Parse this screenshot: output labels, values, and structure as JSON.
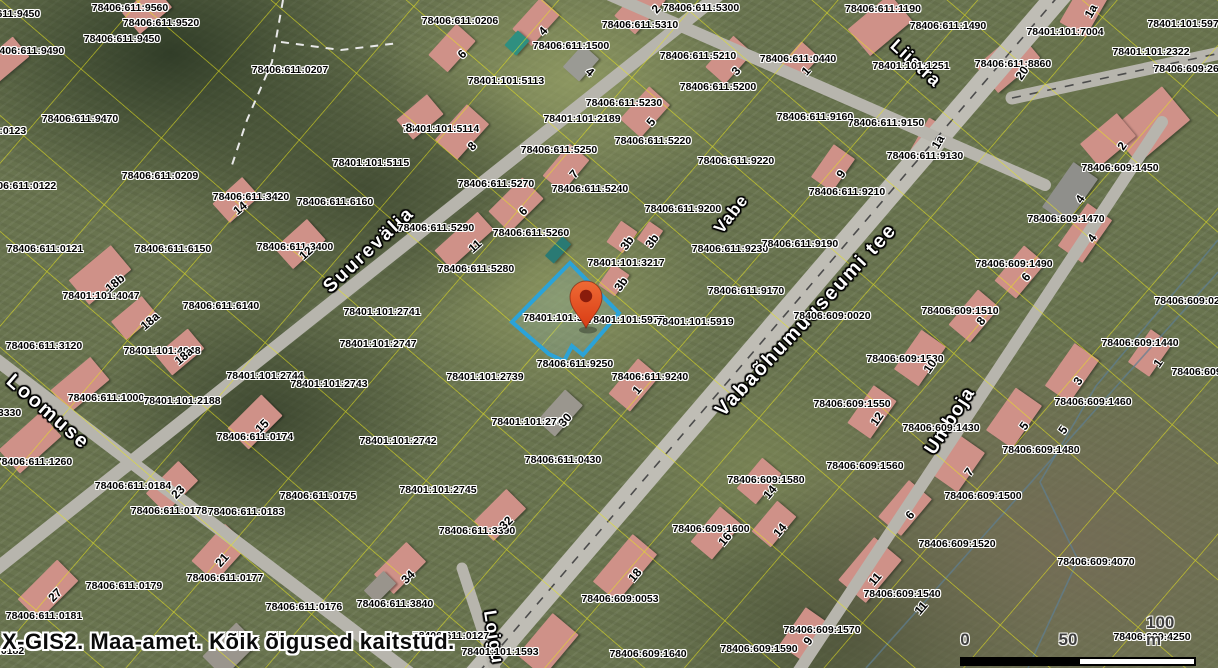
{
  "app": {
    "watermark": "X-GIS2. Maa-amet. Kõik õigused kaitstud."
  },
  "scalebar": {
    "label_0": "0",
    "label_50": "50",
    "label_100": "100 m"
  },
  "colors": {
    "parcel_line": "#e6e41c",
    "road": "#b7b5ad",
    "road_main": "#bfbdb5",
    "highlight": "#2ba3d8",
    "highlight_fill": "rgba(140,205,238,0.14)",
    "pin_top": "#ef6a35",
    "pin_bottom": "#d93c14",
    "pin_hole": "#8a1c0c",
    "dash": "#4c4c4c",
    "dash_white": "#e9e9e9",
    "stream": "#5e7f93",
    "building": "#cf9188",
    "scalebar_black": "#000000",
    "scalebar_white": "#ffffff"
  },
  "streets": [
    {
      "name": "Suurevälja",
      "x": 369,
      "y": 250,
      "rot": -43,
      "size": 19,
      "ls": 2
    },
    {
      "name": "Vabe",
      "x": 731,
      "y": 214,
      "rot": -52,
      "size": 17,
      "ls": 1
    },
    {
      "name": "Vabaõhumuuseumi tee",
      "x": 806,
      "y": 320,
      "rot": -47,
      "size": 20,
      "ls": 2
    },
    {
      "name": "Loomuse",
      "x": 48,
      "y": 412,
      "rot": 41,
      "size": 20,
      "ls": 2
    },
    {
      "name": "Umboja",
      "x": 950,
      "y": 421,
      "rot": -57,
      "size": 19,
      "ls": 1
    },
    {
      "name": "Liistra",
      "x": 916,
      "y": 63,
      "rot": 42,
      "size": 18,
      "ls": 1
    },
    {
      "name": "Loigu",
      "x": 494,
      "y": 637,
      "rot": 81,
      "size": 18,
      "ls": 1
    }
  ],
  "parcel_labels": [
    [
      "78406:611:9560",
      130,
      8
    ],
    [
      "78406:611:9520",
      161,
      23
    ],
    [
      "78406:611:9450",
      122,
      39
    ],
    [
      "78406:611:9450",
      2,
      14
    ],
    [
      "78406:611:9490",
      26,
      51
    ],
    [
      "78406:611:0207",
      290,
      70
    ],
    [
      "78406:611:9470",
      80,
      119
    ],
    [
      "78406:611:0123",
      -12,
      131
    ],
    [
      "78401:101:5115",
      371,
      163
    ],
    [
      "78401:101:5114",
      441,
      129
    ],
    [
      "78406:611:0206",
      460,
      21
    ],
    [
      "78406:611:5300",
      701,
      8
    ],
    [
      "78406:611:5310",
      640,
      25
    ],
    [
      "78406:611:1500",
      571,
      46
    ],
    [
      "78401:101:5113",
      506,
      81
    ],
    [
      "78406:611:5210",
      698,
      56
    ],
    [
      "78406:611:5200",
      718,
      87
    ],
    [
      "78406:611:0440",
      798,
      59
    ],
    [
      "78406:611:5230",
      624,
      103
    ],
    [
      "78401:101:2189",
      582,
      119
    ],
    [
      "78406:611:5220",
      653,
      141
    ],
    [
      "78406:611:5250",
      559,
      150
    ],
    [
      "78406:611:9220",
      736,
      161
    ],
    [
      "78406:611:1190",
      883,
      9
    ],
    [
      "78406:611:1490",
      948,
      26
    ],
    [
      "78401:101:7004",
      1065,
      32
    ],
    [
      "78401:101:5970",
      1186,
      24
    ],
    [
      "78401:101:2322",
      1151,
      52
    ],
    [
      "78406:609:2610",
      1192,
      69
    ],
    [
      "78401:101:1251",
      911,
      66
    ],
    [
      "78406:611:8860",
      1013,
      64
    ],
    [
      "78406:611:9160",
      815,
      117
    ],
    [
      "78406:611:9150",
      886,
      123
    ],
    [
      "78406:611:9130",
      925,
      156
    ],
    [
      "78406:609:1450",
      1120,
      168
    ],
    [
      "78406:611:0209",
      160,
      176
    ],
    [
      "78406:611:0122",
      18,
      186
    ],
    [
      "78406:611:3420",
      251,
      197
    ],
    [
      "78406:611:6160",
      335,
      202
    ],
    [
      "78406:611:0121",
      45,
      249
    ],
    [
      "78406:611:6150",
      173,
      249
    ],
    [
      "78406:611:3400",
      295,
      247
    ],
    [
      "78401:101:4047",
      101,
      296
    ],
    [
      "78406:611:6140",
      221,
      306
    ],
    [
      "78406:611:5270",
      496,
      184
    ],
    [
      "78406:611:5240",
      590,
      189
    ],
    [
      "78406:611:9200",
      683,
      209
    ],
    [
      "78406:611:5290",
      436,
      228
    ],
    [
      "78406:611:5260",
      531,
      233
    ],
    [
      "78406:611:5280",
      476,
      269
    ],
    [
      "78401:101:3217",
      626,
      263
    ],
    [
      "78406:611:9230",
      730,
      249
    ],
    [
      "78406:611:9170",
      746,
      291
    ],
    [
      "78406:611:9190",
      800,
      244
    ],
    [
      "78401:101:2741",
      382,
      312
    ],
    [
      "78401:101:32",
      556,
      318
    ],
    [
      "78401:101:5977",
      626,
      320
    ],
    [
      "78401:101:5919",
      695,
      322
    ],
    [
      "78406:611:9210",
      847,
      192
    ],
    [
      "78406:609:1470",
      1066,
      219
    ],
    [
      "78406:609:1490",
      1014,
      264
    ],
    [
      "78406:609:1510",
      960,
      311
    ],
    [
      "78406:609:0020",
      832,
      316
    ],
    [
      "78406:609:0260",
      1193,
      301
    ],
    [
      "78406:611:3120",
      44,
      346
    ],
    [
      "78401:101:4048",
      162,
      351
    ],
    [
      "78401:101:2747",
      378,
      344
    ],
    [
      "78401:101:2744",
      265,
      376
    ],
    [
      "78401:101:2743",
      329,
      384
    ],
    [
      "78406:611:1000",
      106,
      398
    ],
    [
      "78401:101:2188",
      182,
      401
    ],
    [
      "78406:611:3330",
      -17,
      413
    ],
    [
      "78406:611:1260",
      34,
      462
    ],
    [
      "78406:611:0174",
      255,
      437
    ],
    [
      "78406:611:0184",
      133,
      486
    ],
    [
      "78401:101:2742",
      398,
      441
    ],
    [
      "78406:611:0175",
      318,
      496
    ],
    [
      "78406:611:0178",
      169,
      511
    ],
    [
      "78406:611:0183",
      246,
      512
    ],
    [
      "78406:611:0179",
      124,
      586
    ],
    [
      "78406:611:0177",
      225,
      578
    ],
    [
      "78406:611:0181",
      44,
      616
    ],
    [
      "78406:611:0176",
      304,
      607
    ],
    [
      "78406:611:3840",
      395,
      604
    ],
    [
      "78406:611:0182",
      -14,
      651
    ],
    [
      "78406:611:3390",
      477,
      531
    ],
    [
      "78406:609:1600",
      711,
      529
    ],
    [
      "78406:609:0053",
      620,
      599
    ],
    [
      "78406:611:0127",
      451,
      636
    ],
    [
      "78401:101:1593",
      500,
      652
    ],
    [
      "78406:609:1640",
      648,
      654
    ],
    [
      "78406:609:1590",
      759,
      649
    ],
    [
      "78406:609:1570",
      822,
      630
    ],
    [
      "78406:609:1520",
      957,
      544
    ],
    [
      "78406:609:1540",
      902,
      594
    ],
    [
      "78406:609:4070",
      1096,
      562
    ],
    [
      "78406:609:4250",
      1152,
      637
    ],
    [
      "78406:609:1530",
      905,
      359
    ],
    [
      "78406:609:1550",
      852,
      404
    ],
    [
      "78406:609:1430",
      941,
      428
    ],
    [
      "78406:609:1560",
      865,
      466
    ],
    [
      "78406:609:1460",
      1093,
      402
    ],
    [
      "78406:609:1480",
      1041,
      450
    ],
    [
      "78406:609:1500",
      983,
      496
    ],
    [
      "78406:609:1440",
      1140,
      343
    ],
    [
      "78406:609:4060",
      1210,
      372
    ],
    [
      "78406:611:9250",
      575,
      364
    ],
    [
      "78401:101:2739",
      485,
      377
    ],
    [
      "78406:611:9240",
      650,
      377
    ],
    [
      "78401:101:2746",
      530,
      422
    ],
    [
      "78406:611:0430",
      563,
      460
    ],
    [
      "78401:101:2745",
      438,
      490
    ],
    [
      "78406:609:1580",
      766,
      480
    ]
  ],
  "house_numbers": [
    [
      "2",
      656,
      9,
      -48
    ],
    [
      "4",
      543,
      31,
      -48
    ],
    [
      "6",
      462,
      54,
      -45
    ],
    [
      "4",
      590,
      72,
      40
    ],
    [
      "3",
      736,
      71,
      -48
    ],
    [
      "1",
      806,
      71,
      -48
    ],
    [
      "8",
      472,
      146,
      -45
    ],
    [
      "5",
      651,
      122,
      -50
    ],
    [
      "8",
      409,
      128,
      0
    ],
    [
      "1a",
      1091,
      11,
      -60
    ],
    [
      "20",
      1022,
      73,
      -55
    ],
    [
      "1a",
      938,
      142,
      -60
    ],
    [
      "2",
      1122,
      146,
      -55
    ],
    [
      "14",
      240,
      208,
      -40
    ],
    [
      "12",
      306,
      253,
      -42
    ],
    [
      "18b",
      115,
      283,
      -40
    ],
    [
      "18a",
      150,
      321,
      -40
    ],
    [
      "7",
      574,
      174,
      -50
    ],
    [
      "6",
      523,
      211,
      -45
    ],
    [
      "11",
      475,
      246,
      -42
    ],
    [
      "3b",
      627,
      243,
      -55
    ],
    [
      "3b",
      652,
      241,
      -55
    ],
    [
      "3b",
      621,
      284,
      -55
    ],
    [
      "9",
      841,
      174,
      -55
    ],
    [
      "4",
      1080,
      199,
      -55
    ],
    [
      "4",
      1092,
      238,
      -55
    ],
    [
      "6",
      1026,
      277,
      -50
    ],
    [
      "8",
      981,
      321,
      -50
    ],
    [
      "18a",
      184,
      356,
      -40
    ],
    [
      "15",
      262,
      426,
      -45
    ],
    [
      "23",
      178,
      492,
      -45
    ],
    [
      "21",
      222,
      560,
      -48
    ],
    [
      "27",
      55,
      595,
      -45
    ],
    [
      "34",
      408,
      577,
      -45
    ],
    [
      "32",
      506,
      523,
      -45
    ],
    [
      "16",
      725,
      539,
      -50
    ],
    [
      "14",
      780,
      530,
      -50
    ],
    [
      "18",
      635,
      575,
      -50
    ],
    [
      "14",
      770,
      492,
      -50
    ],
    [
      "30",
      565,
      420,
      -48
    ],
    [
      "1",
      637,
      390,
      -50
    ],
    [
      "9",
      808,
      641,
      -55
    ],
    [
      "6",
      910,
      515,
      -50
    ],
    [
      "11",
      875,
      579,
      -50
    ],
    [
      "11",
      921,
      608,
      -50
    ],
    [
      "10",
      930,
      366,
      -55
    ],
    [
      "12",
      877,
      419,
      -55
    ],
    [
      "3",
      1078,
      381,
      -55
    ],
    [
      "5",
      1024,
      426,
      -55
    ],
    [
      "5",
      1063,
      430,
      -55
    ],
    [
      "7",
      969,
      472,
      -55
    ],
    [
      "1",
      1158,
      363,
      -55
    ]
  ],
  "buildings": [
    [
      640,
      8,
      46,
      28,
      -48
    ],
    [
      536,
      22,
      42,
      26,
      -48
    ],
    [
      452,
      48,
      42,
      26,
      -48
    ],
    [
      581,
      63,
      30,
      22,
      -48,
      "#9a9a94"
    ],
    [
      729,
      60,
      42,
      26,
      -48
    ],
    [
      799,
      62,
      34,
      24,
      -48
    ],
    [
      462,
      132,
      48,
      30,
      -48
    ],
    [
      645,
      112,
      44,
      28,
      -48
    ],
    [
      420,
      117,
      40,
      26,
      -40
    ],
    [
      1085,
      8,
      50,
      30,
      -60
    ],
    [
      880,
      25,
      55,
      35,
      -40
    ],
    [
      1008,
      62,
      55,
      35,
      -40
    ],
    [
      1150,
      125,
      68,
      44,
      -40
    ],
    [
      930,
      140,
      38,
      24,
      -60
    ],
    [
      1108,
      140,
      48,
      30,
      -40
    ],
    [
      147,
      10,
      42,
      28,
      -40
    ],
    [
      236,
      200,
      40,
      26,
      -42
    ],
    [
      300,
      244,
      44,
      28,
      -42
    ],
    [
      100,
      275,
      55,
      32,
      -40
    ],
    [
      134,
      318,
      40,
      24,
      -40
    ],
    [
      566,
      168,
      42,
      26,
      -50
    ],
    [
      516,
      205,
      48,
      30,
      -45
    ],
    [
      464,
      240,
      58,
      24,
      -42
    ],
    [
      622,
      237,
      26,
      20,
      -55
    ],
    [
      650,
      235,
      22,
      17,
      -55
    ],
    [
      614,
      280,
      26,
      20,
      -55
    ],
    [
      833,
      168,
      40,
      26,
      -55
    ],
    [
      1070,
      193,
      55,
      30,
      -55,
      "#8f8f8b"
    ],
    [
      1085,
      233,
      52,
      30,
      -55
    ],
    [
      1020,
      272,
      46,
      28,
      -50
    ],
    [
      974,
      316,
      46,
      28,
      -50
    ],
    [
      180,
      352,
      42,
      26,
      -40
    ],
    [
      80,
      385,
      52,
      30,
      -40
    ],
    [
      255,
      422,
      48,
      30,
      -45
    ],
    [
      172,
      487,
      46,
      28,
      -45
    ],
    [
      48,
      590,
      56,
      30,
      -45
    ],
    [
      220,
      553,
      50,
      32,
      -48
    ],
    [
      400,
      568,
      46,
      28,
      -45
    ],
    [
      500,
      515,
      46,
      28,
      -45
    ],
    [
      716,
      533,
      46,
      28,
      -50
    ],
    [
      774,
      524,
      40,
      25,
      -50
    ],
    [
      625,
      568,
      62,
      32,
      -50
    ],
    [
      560,
      413,
      42,
      24,
      -48,
      "#9a968e"
    ],
    [
      634,
      385,
      46,
      28,
      -50
    ],
    [
      804,
      634,
      46,
      28,
      -55
    ],
    [
      905,
      508,
      48,
      30,
      -50
    ],
    [
      870,
      570,
      56,
      36,
      -50
    ],
    [
      920,
      358,
      48,
      30,
      -55
    ],
    [
      872,
      412,
      46,
      28,
      -55
    ],
    [
      1072,
      373,
      52,
      30,
      -55
    ],
    [
      1014,
      418,
      52,
      32,
      -55
    ],
    [
      959,
      464,
      48,
      30,
      -55
    ],
    [
      1150,
      353,
      40,
      26,
      -55
    ],
    [
      759,
      481,
      40,
      25,
      -50
    ],
    [
      5,
      60,
      42,
      26,
      -40
    ],
    [
      30,
      443,
      56,
      32,
      -42
    ],
    [
      548,
      645,
      55,
      34,
      -50
    ],
    [
      230,
      650,
      48,
      30,
      -45,
      "#9a958d"
    ],
    [
      380,
      587,
      28,
      18,
      -45,
      "#99948c"
    ],
    [
      517,
      43,
      20,
      16,
      -48,
      "#2f8f80"
    ],
    [
      558,
      250,
      26,
      12,
      -48,
      "#2a7a74"
    ]
  ],
  "roads": [
    {
      "x1": 455,
      "y1": 700,
      "x2": 1072,
      "y2": -20,
      "w": 24,
      "dash": true,
      "main": true
    },
    {
      "x1": 725,
      "y1": -10,
      "x2": -15,
      "y2": 578,
      "w": 13,
      "dash": false
    },
    {
      "x1": -10,
      "y1": 355,
      "x2": 445,
      "y2": 700,
      "w": 13,
      "dash": false
    },
    {
      "x1": 462,
      "y1": 568,
      "x2": 505,
      "y2": 700,
      "w": 11,
      "dash": false
    },
    {
      "x1": 610,
      "y1": -5,
      "x2": 1045,
      "y2": 185,
      "w": 12,
      "dash": false
    },
    {
      "x1": 1012,
      "y1": 98,
      "x2": 1225,
      "y2": 52,
      "w": 13,
      "dash": true
    },
    {
      "x1": 1162,
      "y1": 122,
      "x2": 798,
      "y2": 672,
      "w": 12,
      "dash": false
    }
  ],
  "grid": {
    "angle": -49.4,
    "sx": 88,
    "sy": 106
  },
  "streams": [
    "M1218,240 L1096,386 1040,482 1078,560 1028,668",
    "M866,668 L1218,272"
  ],
  "dashed_white": [
    "M283,0 L272,62 247,120 231,168",
    "M281,42 L341,50 399,43"
  ],
  "highlight_parcel": {
    "points": "570,263 619,313 583,355 572,346 564,361 549,354 512,322",
    "visible_label": "78401:101:32",
    "pin": {
      "x": 586,
      "y": 328
    }
  }
}
